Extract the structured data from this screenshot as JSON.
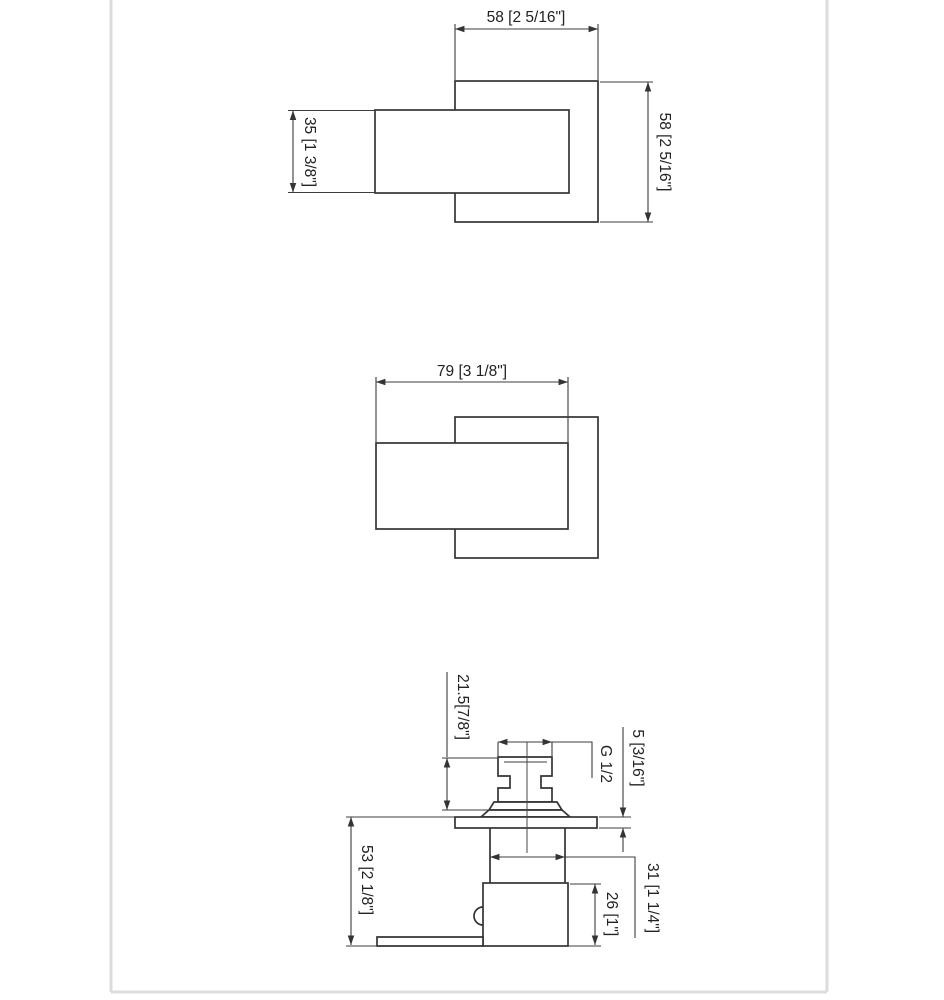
{
  "drawing": {
    "front_view": {
      "plate_width": "58 [2 5/16\"]",
      "plate_height": "58 [2 5/16\"]",
      "handle_height": "35 [1 3/8\"]"
    },
    "plan_view": {
      "handle_length": "79 [3 1/8\"]"
    },
    "side_view": {
      "cartridge_height": "21.5[7/8\"]",
      "thread_size": "G 1/2",
      "plate_thickness": "5 [3/16\"]",
      "overall_depth": "53 [2 1/8\"]",
      "stem_width": "31 [1 1/4\"]",
      "body_depth": "26 [1\"]"
    },
    "colors": {
      "object_line": "#343434",
      "dimension_line": "#3d3d3d",
      "sheet_edge": "#dcdcdc",
      "background": "#ffffff"
    }
  }
}
